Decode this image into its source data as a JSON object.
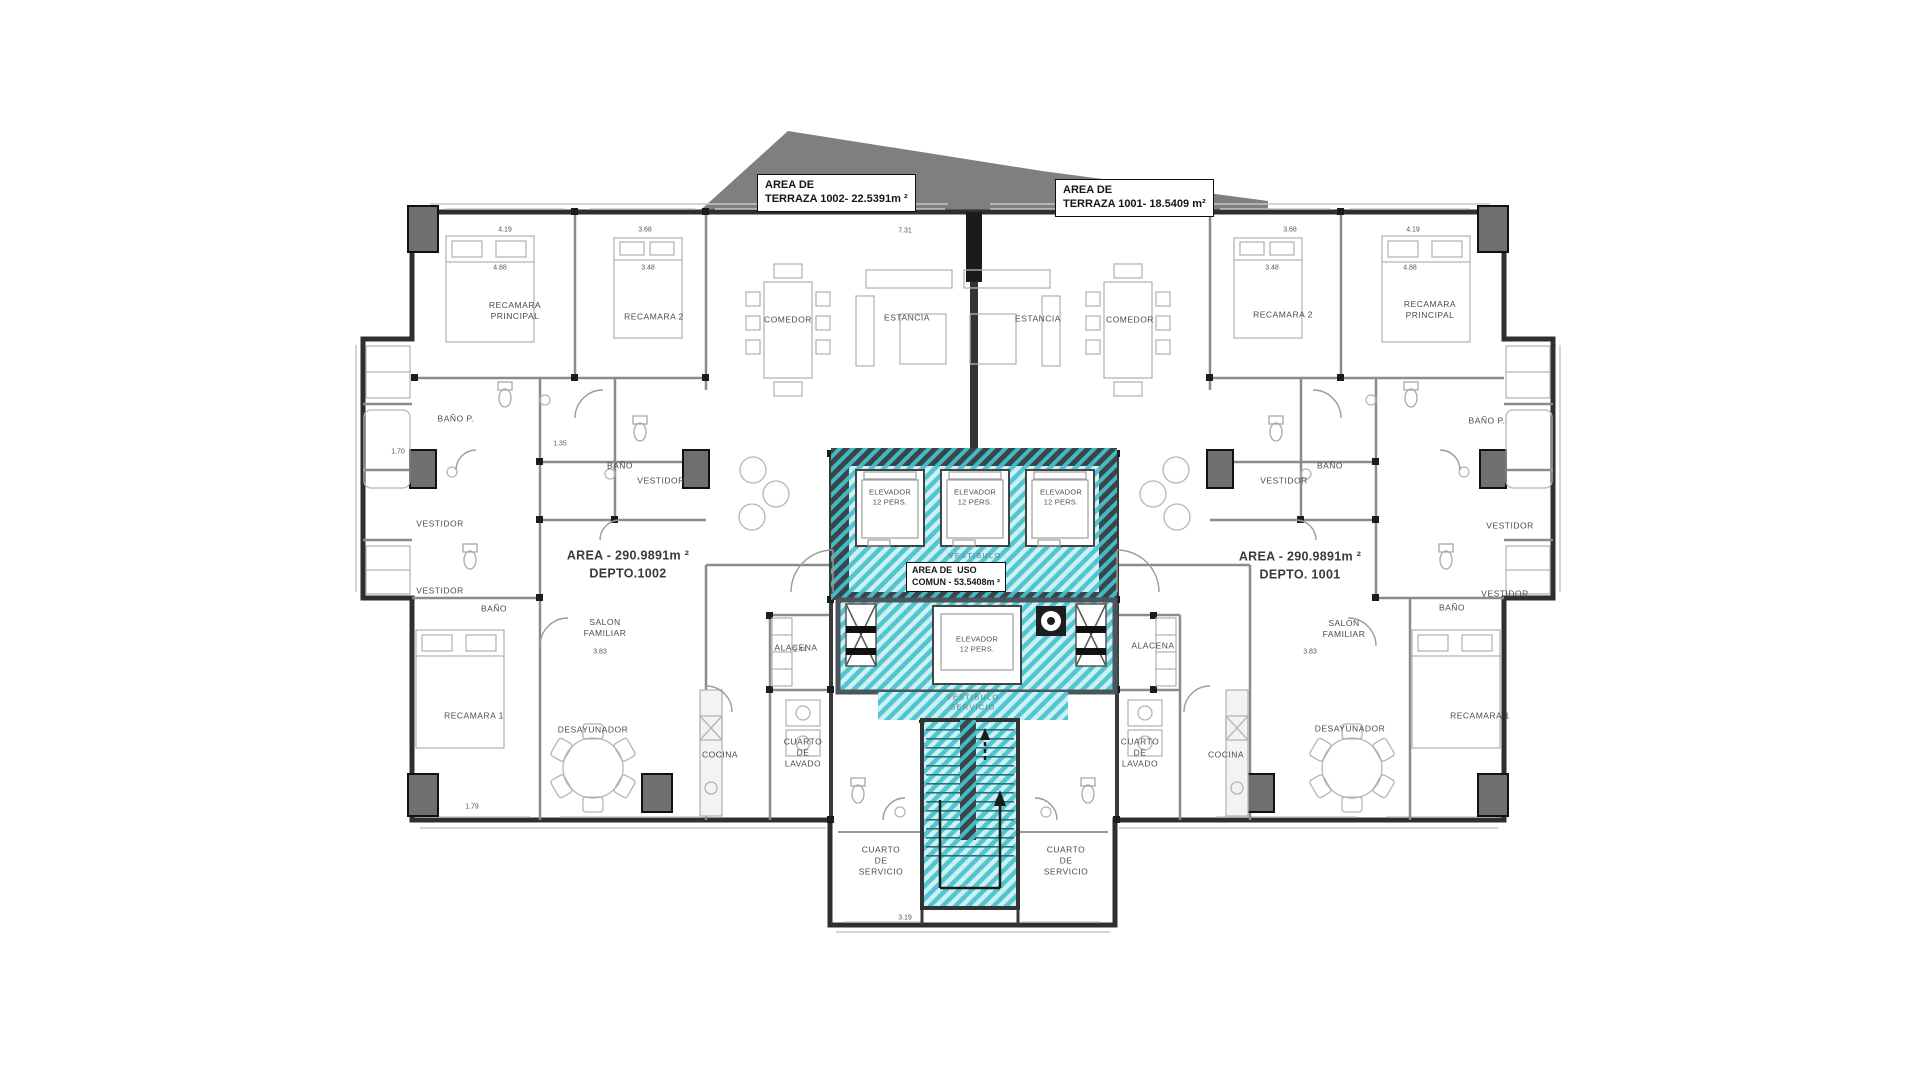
{
  "colors": {
    "common_area_stripe": "#52c6d0",
    "common_area_bg": "#cdf0f4",
    "terrace_gray": "#7f7f7f",
    "exterior_wall": "#2f2f2f"
  },
  "plan": {
    "labels": [
      {
        "name": "terraza-1002-label",
        "cls": "box",
        "x": 757,
        "y": 174,
        "text": "AREA DE\nTERRAZA 1002- 22.5391m ²"
      },
      {
        "name": "terraza-1001-label",
        "cls": "box",
        "x": 1055,
        "y": 179,
        "text": "AREA DE\nTERRAZA 1001- 18.5409 m²"
      },
      {
        "name": "area-uso-comun-label",
        "cls": "box small",
        "x": 906,
        "y": 562,
        "text": "AREA DE  USO\nCOMUN - 53.5408m ²"
      },
      {
        "name": "depto-1002-area-label",
        "cls": "area",
        "x": 628,
        "y": 565,
        "text": "AREA - 290.9891m ²\nDEPTO.1002"
      },
      {
        "name": "depto-1001-area-label",
        "cls": "area",
        "x": 1300,
        "y": 566,
        "text": "AREA - 290.9891m ²\nDEPTO. 1001"
      },
      {
        "name": "recamara-principal-1002",
        "cls": "room",
        "x": 515,
        "y": 311,
        "text": "RECAMARA\nPRINCIPAL"
      },
      {
        "name": "recamara-2-1002",
        "cls": "room",
        "x": 654,
        "y": 317,
        "text": "RECAMARA 2"
      },
      {
        "name": "comedor-1002",
        "cls": "room",
        "x": 788,
        "y": 320,
        "text": "COMEDOR"
      },
      {
        "name": "estancia-1002",
        "cls": "room",
        "x": 907,
        "y": 318,
        "text": "ESTANCIA"
      },
      {
        "name": "estancia-1001",
        "cls": "room",
        "x": 1038,
        "y": 319,
        "text": "ESTANCIA"
      },
      {
        "name": "comedor-1001",
        "cls": "room",
        "x": 1130,
        "y": 320,
        "text": "COMEDOR"
      },
      {
        "name": "recamara-2-1001",
        "cls": "room",
        "x": 1283,
        "y": 315,
        "text": "RECAMARA 2"
      },
      {
        "name": "recamara-principal-1001",
        "cls": "room",
        "x": 1430,
        "y": 310,
        "text": "RECAMARA\nPRINCIPAL"
      },
      {
        "name": "bano-p-1002",
        "cls": "room",
        "x": 456,
        "y": 419,
        "text": "BAÑO P."
      },
      {
        "name": "bano-1002",
        "cls": "room",
        "x": 620,
        "y": 466,
        "text": "BAÑO"
      },
      {
        "name": "vestidor-1002-a",
        "cls": "room",
        "x": 440,
        "y": 524,
        "text": "VESTIDOR"
      },
      {
        "name": "vestidor-1002-b",
        "cls": "room",
        "x": 661,
        "y": 481,
        "text": "VESTIDOR"
      },
      {
        "name": "vestidor-1002-c",
        "cls": "room",
        "x": 440,
        "y": 591,
        "text": "VESTIDOR"
      },
      {
        "name": "bano-1002-b",
        "cls": "room",
        "x": 494,
        "y": 609,
        "text": "BAÑO"
      },
      {
        "name": "salon-familiar-1002",
        "cls": "room",
        "x": 605,
        "y": 628,
        "text": "SALON\nFAMILIAR"
      },
      {
        "name": "recamara-1-1002",
        "cls": "room",
        "x": 474,
        "y": 716,
        "text": "RECAMARA 1"
      },
      {
        "name": "desayunador-1002",
        "cls": "room",
        "x": 593,
        "y": 730,
        "text": "DESAYUNADOR"
      },
      {
        "name": "cocina-1002",
        "cls": "room",
        "x": 720,
        "y": 755,
        "text": "COCINA"
      },
      {
        "name": "alacena-1002",
        "cls": "room",
        "x": 796,
        "y": 648,
        "text": "ALACENA"
      },
      {
        "name": "cuarto-lavado-1002",
        "cls": "room",
        "x": 803,
        "y": 753,
        "text": "CUARTO\nDE\nLAVADO"
      },
      {
        "name": "bano-1001",
        "cls": "room",
        "x": 1330,
        "y": 466,
        "text": "BAÑO"
      },
      {
        "name": "vestidor-1001-a",
        "cls": "room",
        "x": 1284,
        "y": 481,
        "text": "VESTIDOR"
      },
      {
        "name": "bano-p-1001",
        "cls": "room",
        "x": 1487,
        "y": 421,
        "text": "BAÑO P."
      },
      {
        "name": "vestidor-1001-b",
        "cls": "room",
        "x": 1510,
        "y": 526,
        "text": "VESTIDOR"
      },
      {
        "name": "vestidor-1001-c",
        "cls": "room",
        "x": 1505,
        "y": 594,
        "text": "VESTIDOR"
      },
      {
        "name": "bano-1001-b",
        "cls": "room",
        "x": 1452,
        "y": 608,
        "text": "BAÑO"
      },
      {
        "name": "salon-familiar-1001",
        "cls": "room",
        "x": 1344,
        "y": 629,
        "text": "SALON\nFAMILIAR"
      },
      {
        "name": "recamara-1-1001",
        "cls": "room",
        "x": 1480,
        "y": 716,
        "text": "RECAMARA 1"
      },
      {
        "name": "desayunador-1001",
        "cls": "room",
        "x": 1350,
        "y": 729,
        "text": "DESAYUNADOR"
      },
      {
        "name": "cocina-1001",
        "cls": "room",
        "x": 1226,
        "y": 755,
        "text": "COCINA"
      },
      {
        "name": "alacena-1001",
        "cls": "room",
        "x": 1153,
        "y": 646,
        "text": "ALACENA"
      },
      {
        "name": "cuarto-lavado-1001",
        "cls": "room",
        "x": 1140,
        "y": 753,
        "text": "CUARTO\nDE\nLAVADO"
      },
      {
        "name": "elevador-1-label",
        "cls": "room elev",
        "x": 890,
        "y": 497,
        "text": "ELEVADOR\n12 PERS."
      },
      {
        "name": "elevador-2-label",
        "cls": "room elev",
        "x": 975,
        "y": 497,
        "text": "ELEVADOR\n12 PERS."
      },
      {
        "name": "elevador-3-label",
        "cls": "room elev",
        "x": 1061,
        "y": 497,
        "text": "ELEVADOR\n12 PERS."
      },
      {
        "name": "elevador-4-label",
        "cls": "room elev",
        "x": 977,
        "y": 644,
        "text": "ELEVADOR\n12 PERS."
      },
      {
        "name": "vestibulo-label",
        "cls": "room faint",
        "x": 975,
        "y": 556,
        "text": "VESTIBULO"
      },
      {
        "name": "vestibulo-servicio-label",
        "cls": "room faint",
        "x": 973,
        "y": 702,
        "text": "VESTIBULO\nSERVICIO"
      },
      {
        "name": "cuarto-servicio-1002",
        "cls": "room",
        "x": 881,
        "y": 861,
        "text": "CUARTO\nDE\nSERVICIO"
      },
      {
        "name": "cuarto-servicio-1001",
        "cls": "room",
        "x": 1066,
        "y": 861,
        "text": "CUARTO\nDE\nSERVICIO"
      }
    ],
    "dimensions": [
      {
        "x": 505,
        "y": 230,
        "text": "4.19"
      },
      {
        "x": 645,
        "y": 230,
        "text": "3.68"
      },
      {
        "x": 905,
        "y": 231,
        "text": "7.31"
      },
      {
        "x": 1290,
        "y": 230,
        "text": "3.68"
      },
      {
        "x": 1413,
        "y": 230,
        "text": "4.19"
      },
      {
        "x": 500,
        "y": 268,
        "text": "4.88"
      },
      {
        "x": 648,
        "y": 268,
        "text": "3.48"
      },
      {
        "x": 1272,
        "y": 268,
        "text": "3.48"
      },
      {
        "x": 1410,
        "y": 268,
        "text": "4.88"
      },
      {
        "x": 600,
        "y": 652,
        "text": "3.83"
      },
      {
        "x": 800,
        "y": 650,
        "text": "2.44"
      },
      {
        "x": 398,
        "y": 452,
        "text": "1.70"
      },
      {
        "x": 560,
        "y": 444,
        "text": "1.35"
      },
      {
        "x": 472,
        "y": 807,
        "text": "1.79"
      },
      {
        "x": 905,
        "y": 918,
        "text": "3.19"
      },
      {
        "x": 1310,
        "y": 652,
        "text": "3.83"
      }
    ]
  }
}
